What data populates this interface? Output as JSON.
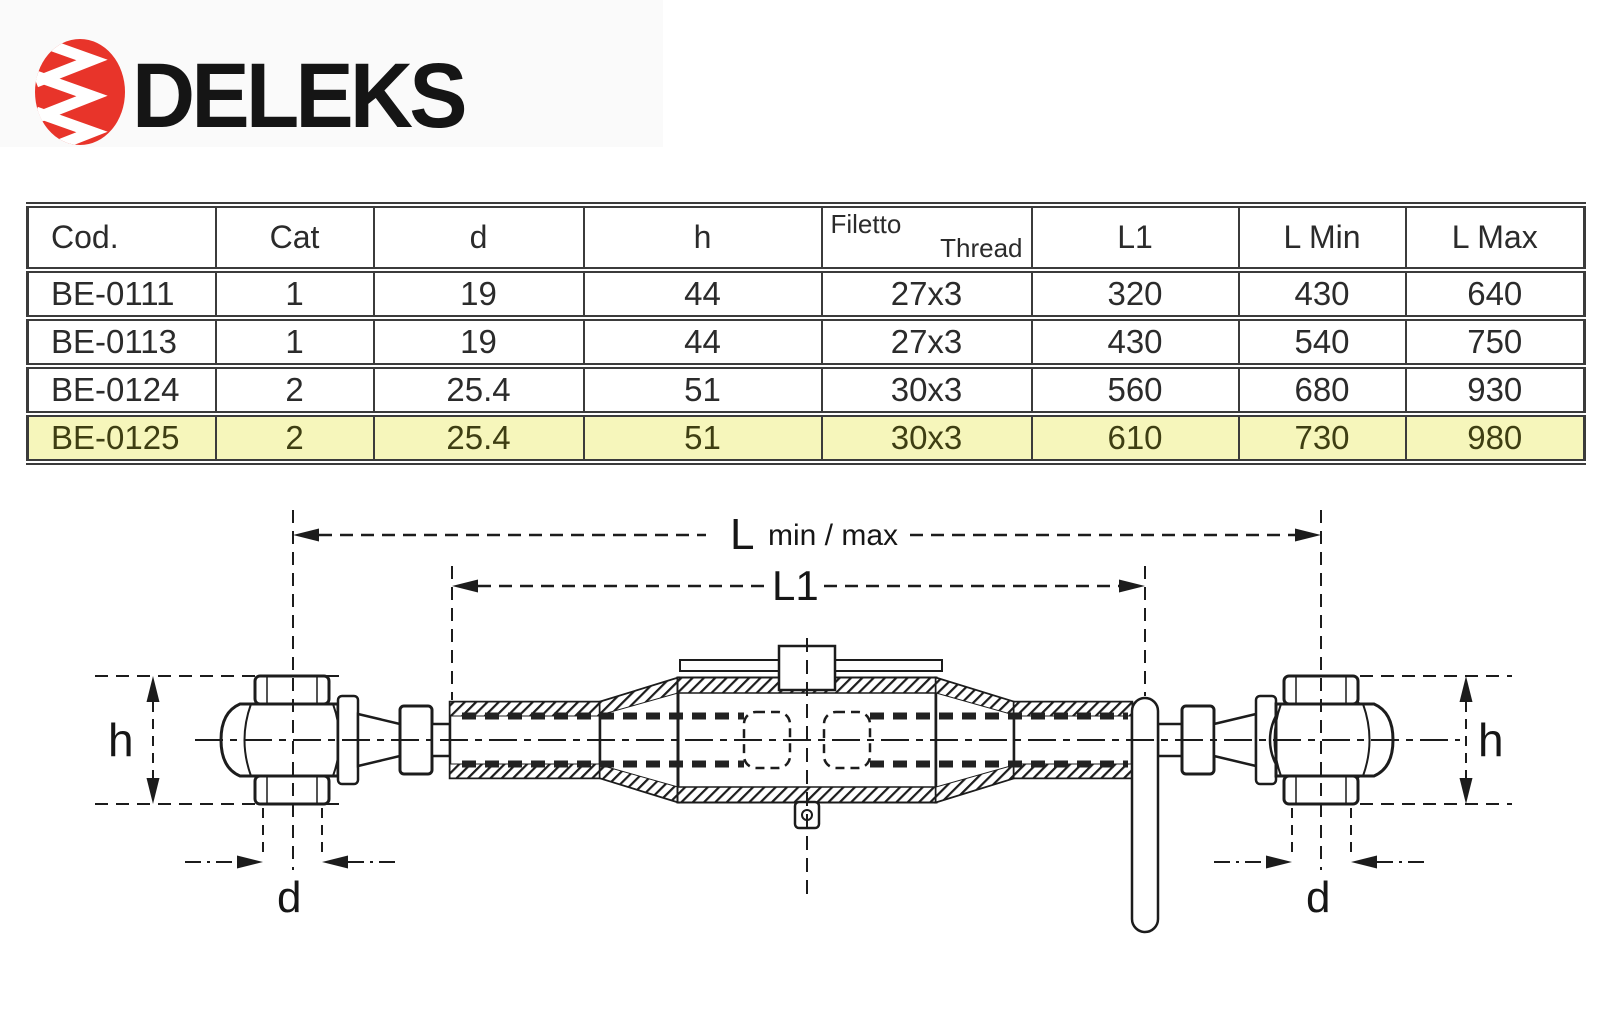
{
  "logo": {
    "brand": "DELEKS",
    "accent_color": "#e8342a",
    "text_color": "#151515"
  },
  "table": {
    "highlight_color": "#f6f6bb",
    "headers": {
      "cod": "Cod.",
      "cat": "Cat",
      "d": "d",
      "h": "h",
      "thread_it": "Filetto",
      "thread_en": "Thread",
      "l1": "L1",
      "lmin": "L Min",
      "lmax": "L Max"
    },
    "rows": [
      {
        "cod": "BE-0111",
        "cat": "1",
        "d": "19",
        "h": "44",
        "thread": "27x3",
        "l1": "320",
        "lmin": "430",
        "lmax": "640"
      },
      {
        "cod": "BE-0113",
        "cat": "1",
        "d": "19",
        "h": "44",
        "thread": "27x3",
        "l1": "430",
        "lmin": "540",
        "lmax": "750"
      },
      {
        "cod": "BE-0124",
        "cat": "2",
        "d": "25.4",
        "h": "51",
        "thread": "30x3",
        "l1": "560",
        "lmin": "680",
        "lmax": "930"
      },
      {
        "cod": "BE-0125",
        "cat": "2",
        "d": "25.4",
        "h": "51",
        "thread": "30x3",
        "l1": "610",
        "lmin": "730",
        "lmax": "980",
        "highlighted": true
      }
    ]
  },
  "diagram": {
    "labels": {
      "l": "L",
      "l_minmax": "min / max",
      "l1": "L1",
      "h": "h",
      "d": "d"
    }
  }
}
